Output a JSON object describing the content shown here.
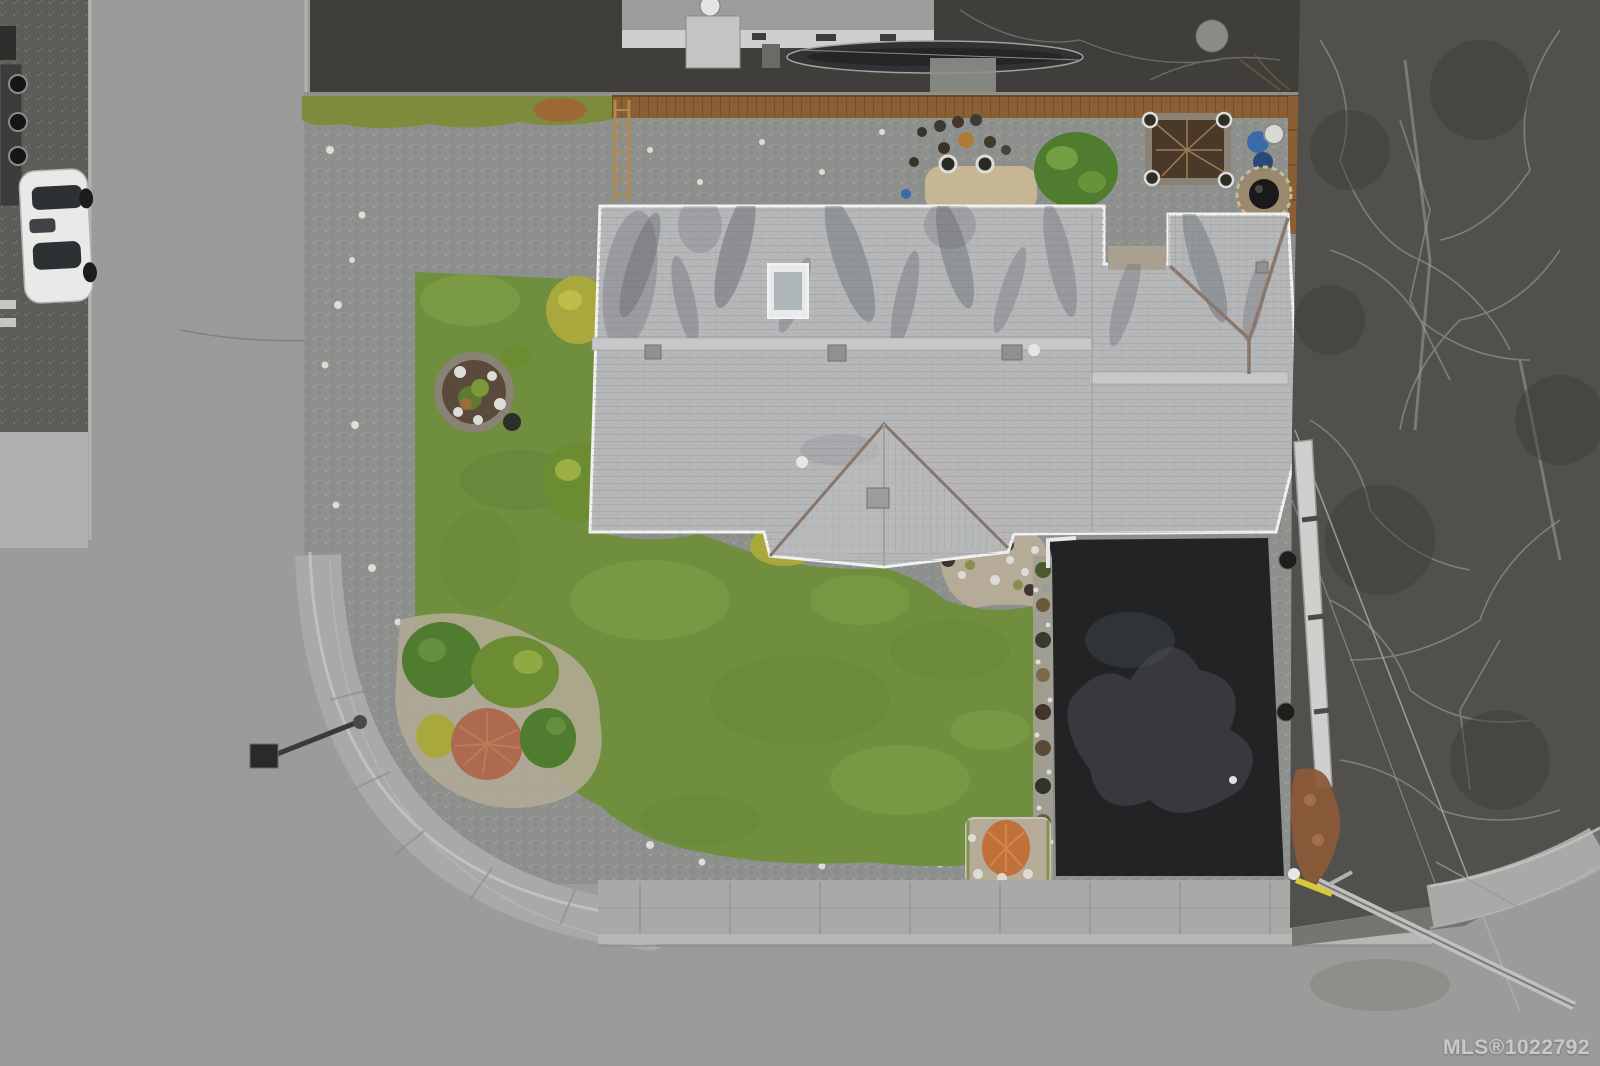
{
  "meta": {
    "image_kind": "aerial-drone-photo",
    "subject": "top-down view of a corner-lot house; property shown in color, surroundings desaturated to grayscale"
  },
  "watermark": {
    "text": "MLS®1022792"
  },
  "palette": {
    "road": "#9b9b99",
    "sidewalk": "#a9a9a7",
    "curb": "#c6c6c4",
    "dark-surround": "#403e3b",
    "neighbor-strip": "#5e5c58",
    "trees": "#52504c",
    "branch": "#908e8a",
    "verge": "#6e6e6a",
    "gravel": "#8e908e",
    "stone": "#dedcd6",
    "moss": "#7e8a33",
    "rust": "#a25f35",
    "lawn": "#6f8f3f",
    "lawn-light": "#8fae4e",
    "lawn-dark": "#5d7a33",
    "mulch": "#b5ab98",
    "soil": "#5a4a3c",
    "ring": "#8a8274",
    "roof": "#b5b7b9",
    "roof-light": "#c6c8ca",
    "streak": "#5f6166",
    "valley": "#8a7668",
    "fascia": "#f2f2f0",
    "fence": "#8a5f33",
    "fence-dark": "#6b4a26",
    "ladder": "#b08a4e",
    "driveway": "#212325",
    "drive-patch": "#4b4d50",
    "patio": "#c7b694",
    "bed-soil": "#4a3828",
    "bush-green": "#4f7c2e",
    "bush-olive": "#6c8c34",
    "bush-yellow": "#a8a83c",
    "bush-red": "#ad6a4e",
    "orange-plant": "#c0703a",
    "terracotta": "#b07a3a",
    "blue-bin": "#3a6aaa",
    "blue-dark": "#2a4878",
    "white-pot": "#dcdcda",
    "car": "#e9e9e7",
    "glass": "#2e3134",
    "pole": "#c0c0be",
    "yellow-mark": "#d8c83a",
    "watermark": "#f0f0f0"
  },
  "scene": {
    "objects": [
      "street-left",
      "street-bottom",
      "corner-sidewalk",
      "white-car",
      "utility-trailer",
      "neighbor-house",
      "boat",
      "wood-fence",
      "ladder",
      "gravel-yard",
      "moss-strip",
      "lawn",
      "circular-garden-bed",
      "shrub-cluster",
      "red-bush",
      "house-roof",
      "skylight",
      "front-gable",
      "hip-roof",
      "asphalt-driveway",
      "patio-pad",
      "raised-garden-bed",
      "fire-pit",
      "blue-bins",
      "planter-pots",
      "rock-garden",
      "street-lamp",
      "bare-trees",
      "power-line",
      "leaning-pole",
      "yellow-curb-mark",
      "mls-watermark"
    ]
  }
}
